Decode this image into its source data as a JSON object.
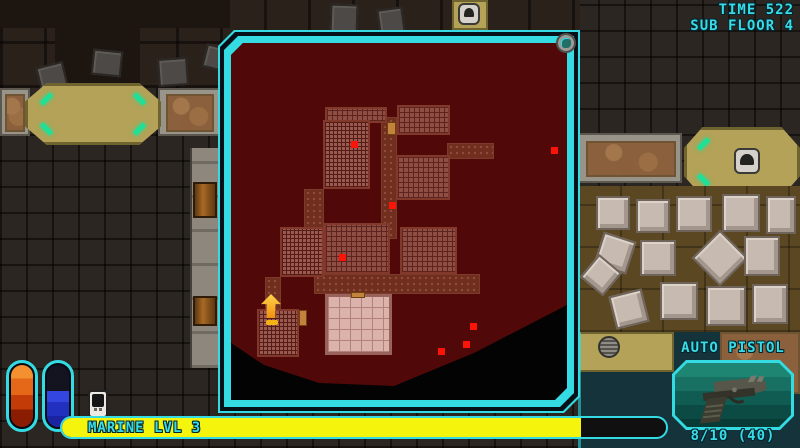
{
  "hud": {
    "time_label": "TIME 522",
    "floor_label": "SUB FLOOR 4",
    "weapon": {
      "name": "AUTO PISTOL",
      "ammo": "8/10 (40)"
    },
    "xp": {
      "label": "MARINE LVL 3",
      "fill_percent": 86
    },
    "accent_color": "#35dbe3",
    "xp_fill_color": "#f4f40c"
  },
  "vials": [
    {
      "name": "health-vial",
      "fill_percent": 100,
      "color": "#e05a10"
    },
    {
      "name": "energy-vial",
      "fill_percent": 58,
      "color": "#2230c0"
    }
  ],
  "map": {
    "background_color": "#500808",
    "explored_polygon": "0px 0px,348px 0px,348px 246px,336px 262px,243px 310px,163px 343px,88px 340px,33px 322px,0px 300px",
    "rooms": [
      {
        "x": 150,
        "y": 74,
        "w": 16,
        "h": 122,
        "type": "corridor"
      },
      {
        "x": 216,
        "y": 100,
        "w": 47,
        "h": 16,
        "type": "corridor"
      },
      {
        "x": 73,
        "y": 146,
        "w": 20,
        "h": 40,
        "type": "corridor"
      },
      {
        "x": 83,
        "y": 231,
        "w": 166,
        "h": 20,
        "type": "corridor"
      },
      {
        "x": 34,
        "y": 234,
        "w": 16,
        "h": 36,
        "type": "corridor"
      },
      {
        "x": 94,
        "y": 64,
        "w": 62,
        "h": 16,
        "type": "tiles"
      },
      {
        "x": 166,
        "y": 62,
        "w": 53,
        "h": 30,
        "type": "tiles"
      },
      {
        "x": 92,
        "y": 77,
        "w": 47,
        "h": 69,
        "type": "dense"
      },
      {
        "x": 165,
        "y": 112,
        "w": 54,
        "h": 45,
        "type": "tiles"
      },
      {
        "x": 49,
        "y": 184,
        "w": 44,
        "h": 50,
        "type": "dense"
      },
      {
        "x": 93,
        "y": 180,
        "w": 66,
        "h": 51,
        "type": "tiles"
      },
      {
        "x": 169,
        "y": 184,
        "w": 57,
        "h": 47,
        "type": "tiles"
      },
      {
        "x": 26,
        "y": 266,
        "w": 42,
        "h": 48,
        "type": "dense"
      },
      {
        "x": 94,
        "y": 251,
        "w": 67,
        "h": 61,
        "type": "light"
      },
      {
        "x": 68,
        "y": 267,
        "w": 8,
        "h": 16,
        "type": "door"
      },
      {
        "x": 120,
        "y": 249,
        "w": 14,
        "h": 6,
        "type": "door"
      },
      {
        "x": 156,
        "y": 79,
        "w": 9,
        "h": 13,
        "type": "door"
      }
    ],
    "enemies": [
      {
        "x": 120,
        "y": 98
      },
      {
        "x": 158,
        "y": 159
      },
      {
        "x": 320,
        "y": 104
      },
      {
        "x": 108,
        "y": 211
      },
      {
        "x": 239,
        "y": 280
      },
      {
        "x": 232,
        "y": 298
      },
      {
        "x": 207,
        "y": 305
      }
    ],
    "player": {
      "x": 30,
      "y": 251
    },
    "enemy_color": "#fb1407",
    "player_color": "#f5a813"
  }
}
